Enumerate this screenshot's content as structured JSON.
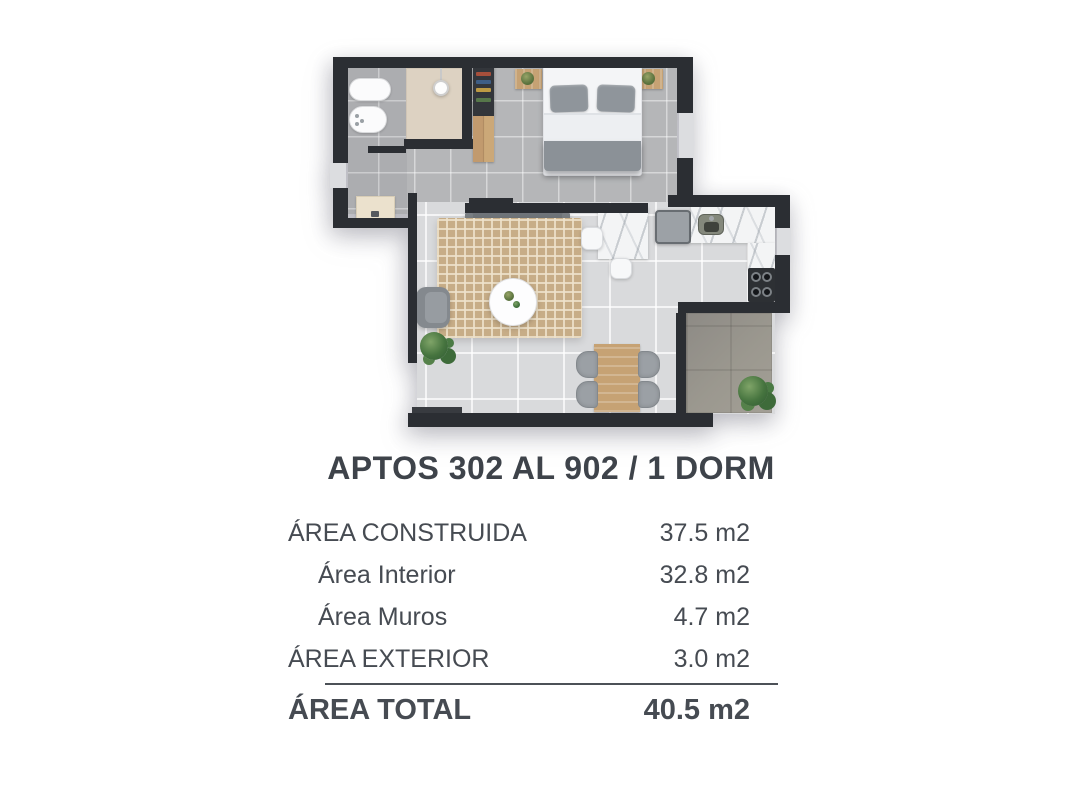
{
  "title": "APTOS 302 AL 902 / 1 DORM",
  "area_table": {
    "rows": [
      {
        "label": "ÁREA CONSTRUIDA",
        "value": "37.5 m2"
      },
      {
        "label": "Área Interior",
        "value": "32.8 m2"
      },
      {
        "label": "Área Muros",
        "value": "4.7 m2"
      },
      {
        "label": "ÁREA EXTERIOR",
        "value": "3.0 m2"
      }
    ],
    "total": {
      "label": "ÁREA TOTAL",
      "value": "40.5 m2"
    }
  },
  "colors": {
    "wall": "#2b2e33",
    "text": "#42464d",
    "floor_interior": "#d9dadc",
    "floor_bedroom": "#b5b6b8",
    "floor_balcony": "#96938d",
    "shower_floor": "#ddd2c2",
    "rug": "#c7ad87",
    "wood": "#c6a274",
    "plant_green": "#46743f",
    "marble": "#f3f4f5"
  }
}
